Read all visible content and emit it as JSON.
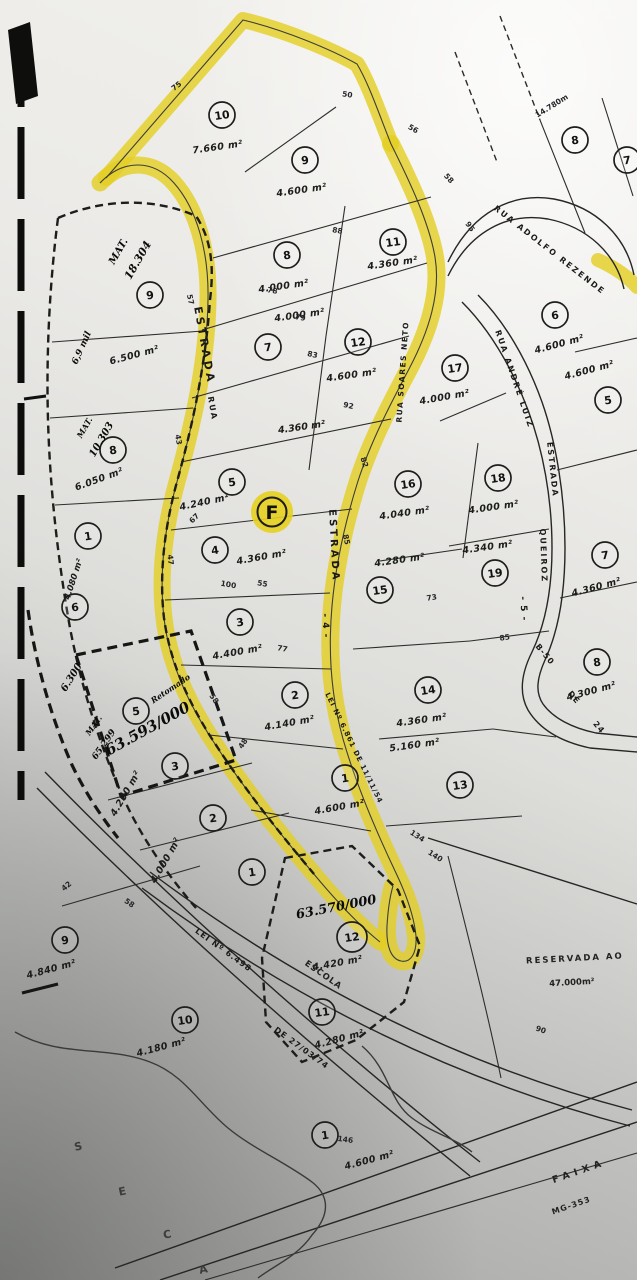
{
  "map": {
    "f_marker": "F",
    "colors": {
      "highlight": "#e4ce20",
      "ink": "#262624",
      "paper": "#eceae6"
    },
    "lots": [
      {
        "sub": "central",
        "n": "10",
        "x": 222,
        "y": 115,
        "area": "7.660 m²",
        "ax": 218,
        "ay": 150,
        "arot": -8
      },
      {
        "sub": "central",
        "n": "9",
        "x": 305,
        "y": 160,
        "area": "4.600 m²",
        "ax": 302,
        "ay": 193,
        "arot": -8
      },
      {
        "sub": "central",
        "n": "8",
        "x": 287,
        "y": 255,
        "area": "4.000 m²",
        "ax": 284,
        "ay": 289,
        "arot": -8
      },
      {
        "sub": "central",
        "n": "11",
        "x": 393,
        "y": 242,
        "area": "4.360 m²",
        "ax": 393,
        "ay": 266,
        "arot": -8
      },
      {
        "sub": "central",
        "n": "7",
        "x": 268,
        "y": 347,
        "area": "4.000 m²",
        "ax": 300,
        "ay": 318,
        "arot": -8
      },
      {
        "sub": "central",
        "n": "12",
        "x": 358,
        "y": 342,
        "area": "4.600 m²",
        "ax": 352,
        "ay": 378,
        "arot": -8
      },
      {
        "sub": "central",
        "n": "5",
        "x": 232,
        "y": 482,
        "area": "4.240 m²",
        "ax": 205,
        "ay": 505,
        "arot": -12
      },
      {
        "sub": "central",
        "n": "4",
        "x": 215,
        "y": 550,
        "area": "4.360 m²",
        "ax": 262,
        "ay": 560,
        "arot": -10
      },
      {
        "sub": "central",
        "n": "3",
        "x": 240,
        "y": 622,
        "area": "4.400 m²",
        "ax": 238,
        "ay": 655,
        "arot": -10
      },
      {
        "sub": "central",
        "n": "2",
        "x": 295,
        "y": 695,
        "area": "4.140 m²",
        "ax": 290,
        "ay": 726,
        "arot": -10
      },
      {
        "sub": "central",
        "n": "1",
        "x": 345,
        "y": 778,
        "area": "4.600 m²",
        "ax": 340,
        "ay": 810,
        "arot": -10
      },
      {
        "sub": "right",
        "n": "6",
        "x": 555,
        "y": 315,
        "area": "4.600 m²",
        "ax": 560,
        "ay": 347,
        "arot": -15
      },
      {
        "sub": "right",
        "n": "17",
        "x": 455,
        "y": 368,
        "area": "4.000 m²",
        "ax": 445,
        "ay": 400,
        "arot": -10
      },
      {
        "sub": "right",
        "n": "5",
        "x": 608,
        "y": 400,
        "area": "4.600 m²",
        "ax": 590,
        "ay": 373,
        "arot": -15
      },
      {
        "sub": "right",
        "n": "16",
        "x": 408,
        "y": 484,
        "area": "4.040 m²",
        "ax": 405,
        "ay": 516,
        "arot": -8
      },
      {
        "sub": "right",
        "n": "18",
        "x": 498,
        "y": 478,
        "area": "4.000 m²",
        "ax": 494,
        "ay": 510,
        "arot": -8
      },
      {
        "sub": "right",
        "n": "19",
        "x": 495,
        "y": 573,
        "area": "4.340 m²",
        "ax": 488,
        "ay": 550,
        "arot": -8
      },
      {
        "sub": "right",
        "n": "15",
        "x": 380,
        "y": 590,
        "area": "4.280 m²",
        "ax": 400,
        "ay": 563,
        "arot": -8
      },
      {
        "sub": "right",
        "n": "7",
        "x": 605,
        "y": 555,
        "area": "4.360 m²",
        "ax": 597,
        "ay": 590,
        "arot": -15
      },
      {
        "sub": "right",
        "n": "8",
        "x": 597,
        "y": 662,
        "area": "4.300 m²",
        "ax": 592,
        "ay": 694,
        "arot": -15
      },
      {
        "sub": "right",
        "n": "14",
        "x": 428,
        "y": 690,
        "area": "4.360 m²",
        "ax": 422,
        "ay": 723,
        "arot": -8
      },
      {
        "sub": "right",
        "n": "13",
        "x": 460,
        "y": 785,
        "area": "5.160 m²",
        "ax": 415,
        "ay": 748,
        "arot": -8
      },
      {
        "sub": "top-right",
        "n": "8",
        "x": 575,
        "y": 140,
        "area": "",
        "ax": 0,
        "ay": 0
      },
      {
        "sub": "top-right",
        "n": "7",
        "x": 627,
        "y": 160,
        "area": "",
        "ax": 0,
        "ay": 0
      },
      {
        "sub": "left",
        "n": "9",
        "x": 150,
        "y": 295,
        "area": "6.500 m²",
        "ax": 135,
        "ay": 358,
        "arot": -15
      },
      {
        "sub": "left",
        "n": "8",
        "x": 113,
        "y": 450,
        "area": "6.050 m²",
        "ax": 100,
        "ay": 482,
        "arot": -20
      },
      {
        "sub": "left",
        "n": "1",
        "x": 88,
        "y": 536,
        "area": "",
        "ax": 0,
        "ay": 0
      },
      {
        "sub": "left",
        "n": "6",
        "x": 75,
        "y": 607,
        "area": "",
        "ax": 0,
        "ay": 0
      },
      {
        "sub": "left",
        "n": "5",
        "x": 136,
        "y": 711,
        "area": "",
        "ax": 0,
        "ay": 0
      },
      {
        "sub": "left",
        "n": "3",
        "x": 175,
        "y": 766,
        "area": "4.200 m²",
        "ax": 128,
        "ay": 795,
        "arot": -60
      },
      {
        "sub": "left",
        "n": "2",
        "x": 213,
        "y": 818,
        "area": "4.000 m²",
        "ax": 168,
        "ay": 862,
        "arot": -60
      },
      {
        "sub": "left",
        "n": "1",
        "x": 252,
        "y": 872,
        "area": "",
        "ax": 0,
        "ay": 0
      },
      {
        "sub": "left",
        "n": "9",
        "x": 65,
        "y": 940,
        "area": "4.840 m²",
        "ax": 52,
        "ay": 972,
        "arot": -15
      },
      {
        "sub": "bottom",
        "n": "12",
        "x": 352,
        "y": 937,
        "r": 15,
        "area": "4.420 m²",
        "ax": 338,
        "ay": 966,
        "arot": -10
      },
      {
        "sub": "bottom",
        "n": "11",
        "x": 322,
        "y": 1012,
        "area": "4.280 m²",
        "ax": 340,
        "ay": 1042,
        "arot": -15
      },
      {
        "sub": "bottom",
        "n": "10",
        "x": 185,
        "y": 1020,
        "area": "4.180 m²",
        "ax": 162,
        "ay": 1050,
        "arot": -15
      },
      {
        "sub": "bottom",
        "n": "1",
        "x": 325,
        "y": 1135,
        "area": "4.600 m²",
        "ax": 370,
        "ay": 1163,
        "arot": -15
      }
    ],
    "street_labels": [
      {
        "text": "ESTRADA",
        "x": 201,
        "y": 346,
        "rot": 80,
        "size": 11,
        "ls": 3
      },
      {
        "text": "RUA",
        "x": 210,
        "y": 409,
        "rot": 80,
        "size": 8,
        "ls": 2
      },
      {
        "text": "RUA SOARES NETO",
        "x": 405,
        "y": 372,
        "rot": -86,
        "size": 7.5,
        "ls": 1.5
      },
      {
        "text": "ESTRADA",
        "x": 331,
        "y": 546,
        "rot": 87,
        "size": 10,
        "ls": 3
      },
      {
        "text": "- 4 -",
        "x": 323,
        "y": 626,
        "rot": 87,
        "size": 9,
        "ls": 1
      },
      {
        "text": "LEI Nº 6.861 DE 11/11/54",
        "x": 352,
        "y": 749,
        "rot": 64,
        "size": 7,
        "ls": 1
      },
      {
        "text": "RUA ADOLFO REZENDE",
        "x": 548,
        "y": 252,
        "rot": 38,
        "size": 8,
        "ls": 2
      },
      {
        "text": "RUA ANDRÉ LUIZ",
        "x": 512,
        "y": 380,
        "rot": 71,
        "size": 8,
        "ls": 2
      },
      {
        "text": "ESTRADA",
        "x": 550,
        "y": 470,
        "rot": 84,
        "size": 8,
        "ls": 2
      },
      {
        "text": "QUEIROZ",
        "x": 541,
        "y": 556,
        "rot": 88,
        "size": 8,
        "ls": 2
      },
      {
        "text": "- 5 -",
        "x": 521,
        "y": 609,
        "rot": 86,
        "size": 9,
        "ls": 1
      },
      {
        "text": "B-50",
        "x": 543,
        "y": 656,
        "rot": 50,
        "size": 8,
        "ls": 1
      },
      {
        "text": "DE",
        "x": 572,
        "y": 699,
        "rot": 50,
        "size": 8,
        "ls": 1
      },
      {
        "text": "24",
        "x": 597,
        "y": 729,
        "rot": 50,
        "size": 8,
        "ls": 1
      },
      {
        "text": "LEI Nº 6.498",
        "x": 222,
        "y": 952,
        "rot": 36,
        "size": 8,
        "ls": 1
      },
      {
        "text": "DE 27/03/74",
        "x": 300,
        "y": 1050,
        "rot": 36,
        "size": 8,
        "ls": 1
      }
    ],
    "printed_labels": [
      {
        "text": "4.360 m²",
        "x": 302,
        "y": 430,
        "rot": -8,
        "size": 9.5,
        "cls": "lot-area"
      },
      {
        "text": "4.080 m²",
        "x": 76,
        "y": 580,
        "rot": -72,
        "size": 8.5,
        "cls": "lot-area"
      },
      {
        "text": "RESERVADA AO",
        "x": 575,
        "y": 961,
        "rot": -3,
        "size": 8.5,
        "ls": 2,
        "cls": "printed"
      },
      {
        "text": "47.000m²",
        "x": 572,
        "y": 985,
        "rot": -3,
        "size": 8.5,
        "cls": "printed"
      },
      {
        "text": "FAIXA",
        "x": 580,
        "y": 1174,
        "rot": -19,
        "size": 9.5,
        "ls": 5,
        "cls": "printed"
      },
      {
        "text": "MG-353",
        "x": 572,
        "y": 1208,
        "rot": -19,
        "size": 8,
        "ls": 1,
        "cls": "printed"
      },
      {
        "text": "ESCOLA",
        "x": 322,
        "y": 977,
        "rot": 35,
        "size": 8.5,
        "ls": 1,
        "cls": "printed"
      },
      {
        "text": "14.780m",
        "x": 553,
        "y": 108,
        "rot": -32,
        "size": 7.5,
        "cls": "dim"
      }
    ],
    "handwritten_labels": [
      {
        "text": "MAT.",
        "x": 121,
        "y": 253,
        "rot": -60,
        "size": 10
      },
      {
        "text": "18.304",
        "x": 141,
        "y": 262,
        "rot": -60,
        "size": 11
      },
      {
        "text": "6,9 mil",
        "x": 84,
        "y": 349,
        "rot": -66,
        "size": 9
      },
      {
        "text": "MAT.",
        "x": 87,
        "y": 429,
        "rot": -60,
        "size": 8
      },
      {
        "text": "10.303",
        "x": 104,
        "y": 441,
        "rot": -60,
        "size": 10
      },
      {
        "text": "6.300",
        "x": 74,
        "y": 679,
        "rot": -58,
        "size": 10
      },
      {
        "text": "MAT.",
        "x": 96,
        "y": 727,
        "rot": -55,
        "size": 8
      },
      {
        "text": "65.299",
        "x": 106,
        "y": 746,
        "rot": -55,
        "size": 9
      },
      {
        "text": "Retomado",
        "x": 172,
        "y": 691,
        "rot": -34,
        "size": 8
      },
      {
        "text": "63.593/000",
        "x": 150,
        "y": 733,
        "rot": -29,
        "size": 15,
        "b": 1
      },
      {
        "text": "63.570/000",
        "x": 337,
        "y": 911,
        "rot": -11,
        "size": 13,
        "b": 1
      }
    ],
    "dims": [
      {
        "t": "75",
        "x": 178,
        "y": 88,
        "r": -38
      },
      {
        "t": "50",
        "x": 347,
        "y": 97,
        "r": 8
      },
      {
        "t": "56",
        "x": 412,
        "y": 131,
        "r": 30
      },
      {
        "t": "58",
        "x": 447,
        "y": 180,
        "r": 48
      },
      {
        "t": "95",
        "x": 468,
        "y": 228,
        "r": 55
      },
      {
        "t": "88",
        "x": 337,
        "y": 233,
        "r": 10
      },
      {
        "t": "78",
        "x": 272,
        "y": 293,
        "r": 10
      },
      {
        "t": "79",
        "x": 300,
        "y": 320,
        "r": 10
      },
      {
        "t": "83",
        "x": 312,
        "y": 357,
        "r": 12
      },
      {
        "t": "92",
        "x": 348,
        "y": 408,
        "r": 12
      },
      {
        "t": "82",
        "x": 362,
        "y": 463,
        "r": 72
      },
      {
        "t": "85",
        "x": 344,
        "y": 540,
        "r": 78
      },
      {
        "t": "57",
        "x": 188,
        "y": 300,
        "r": 78
      },
      {
        "t": "43",
        "x": 176,
        "y": 440,
        "r": 80
      },
      {
        "t": "47",
        "x": 168,
        "y": 560,
        "r": 84
      },
      {
        "t": "67",
        "x": 196,
        "y": 520,
        "r": -45
      },
      {
        "t": "100",
        "x": 228,
        "y": 587,
        "r": 10
      },
      {
        "t": "55",
        "x": 262,
        "y": 586,
        "r": 10
      },
      {
        "t": "77",
        "x": 282,
        "y": 651,
        "r": 10
      },
      {
        "t": "58",
        "x": 212,
        "y": 700,
        "r": 55
      },
      {
        "t": "48",
        "x": 245,
        "y": 745,
        "r": -55
      },
      {
        "t": "85",
        "x": 505,
        "y": 640,
        "r": -8
      },
      {
        "t": "73",
        "x": 432,
        "y": 600,
        "r": -8
      },
      {
        "t": "134",
        "x": 416,
        "y": 838,
        "r": 33
      },
      {
        "t": "140",
        "x": 434,
        "y": 858,
        "r": 33
      },
      {
        "t": "146",
        "x": 345,
        "y": 1142,
        "r": 8
      },
      {
        "t": "90",
        "x": 540,
        "y": 1032,
        "r": 20
      },
      {
        "t": "42",
        "x": 68,
        "y": 888,
        "r": -40
      },
      {
        "t": "58",
        "x": 128,
        "y": 905,
        "r": 35
      }
    ],
    "stream_letters": [
      {
        "t": "S",
        "x": 79,
        "y": 1150
      },
      {
        "t": "E",
        "x": 123,
        "y": 1195
      },
      {
        "t": "C",
        "x": 168,
        "y": 1238
      },
      {
        "t": "A",
        "x": 204,
        "y": 1273
      }
    ]
  }
}
